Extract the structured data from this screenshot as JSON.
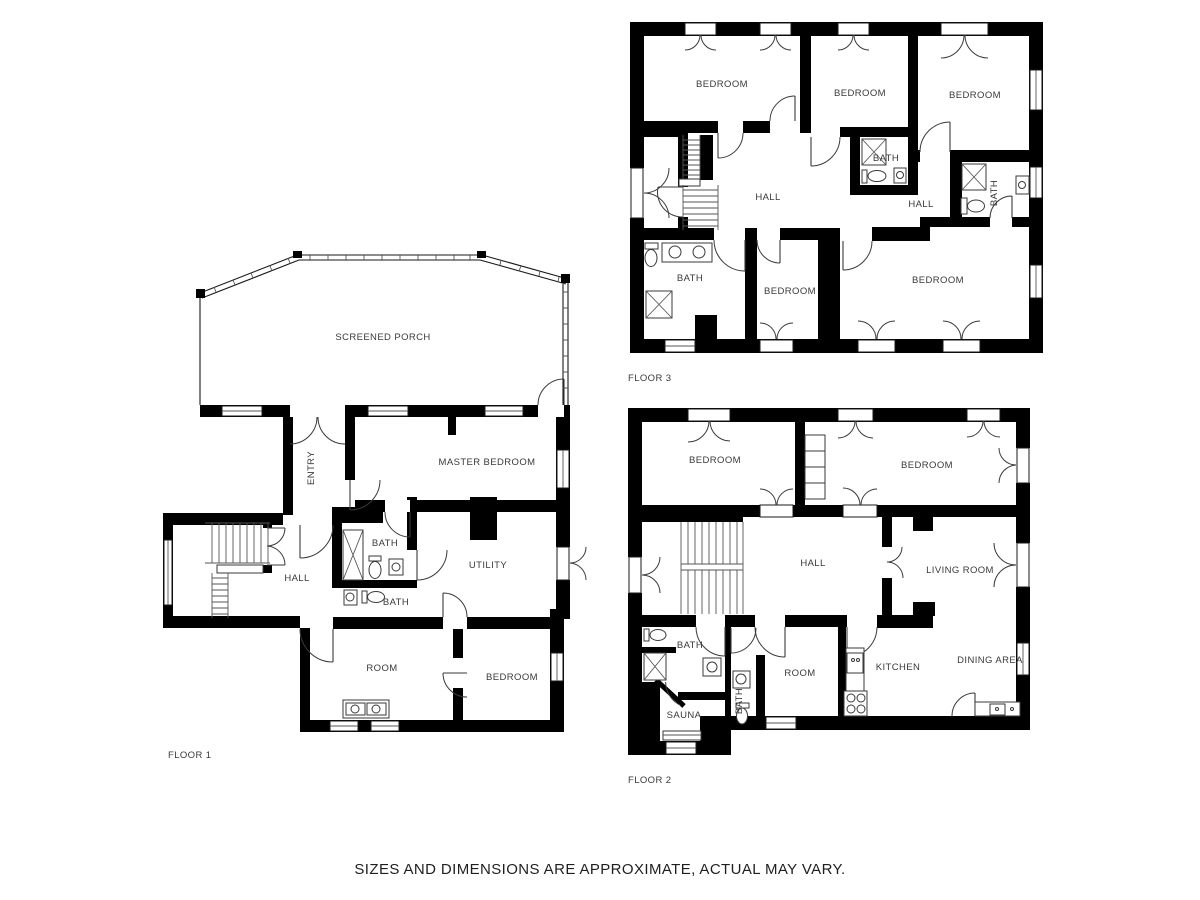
{
  "disclaimer": "SIZES AND DIMENSIONS ARE APPROXIMATE, ACTUAL MAY VARY.",
  "colors": {
    "wall": "#000000",
    "background": "#ffffff",
    "label": "#3a3a3a"
  },
  "floor1": {
    "label": "FLOOR 1",
    "rooms": {
      "screened_porch": "SCREENED PORCH",
      "entry": "ENTRY",
      "master_bedroom": "MASTER BEDROOM",
      "hall": "HALL",
      "bath_upper": "BATH",
      "bath_lower": "BATH",
      "utility": "UTILITY",
      "room": "ROOM",
      "bedroom": "BEDROOM"
    }
  },
  "floor2": {
    "label": "FLOOR 2",
    "rooms": {
      "bedroom_left": "BEDROOM",
      "bedroom_right": "BEDROOM",
      "hall": "HALL",
      "living_room": "LIVING ROOM",
      "bath": "BATH",
      "sauna": "SAUNA",
      "bath_small": "BATH",
      "room": "ROOM",
      "kitchen": "KITCHEN",
      "dining_area": "DINING AREA"
    }
  },
  "floor3": {
    "label": "FLOOR 3",
    "rooms": {
      "bedroom_top_left": "BEDROOM",
      "bedroom_top_mid": "BEDROOM",
      "bedroom_top_right": "BEDROOM",
      "hall_left": "HALL",
      "bath_mid": "BATH",
      "hall_right": "HALL",
      "bath_right": "BATH",
      "bath_bottom": "BATH",
      "bedroom_bottom_mid": "BEDROOM",
      "bedroom_bottom_right": "BEDROOM"
    }
  }
}
